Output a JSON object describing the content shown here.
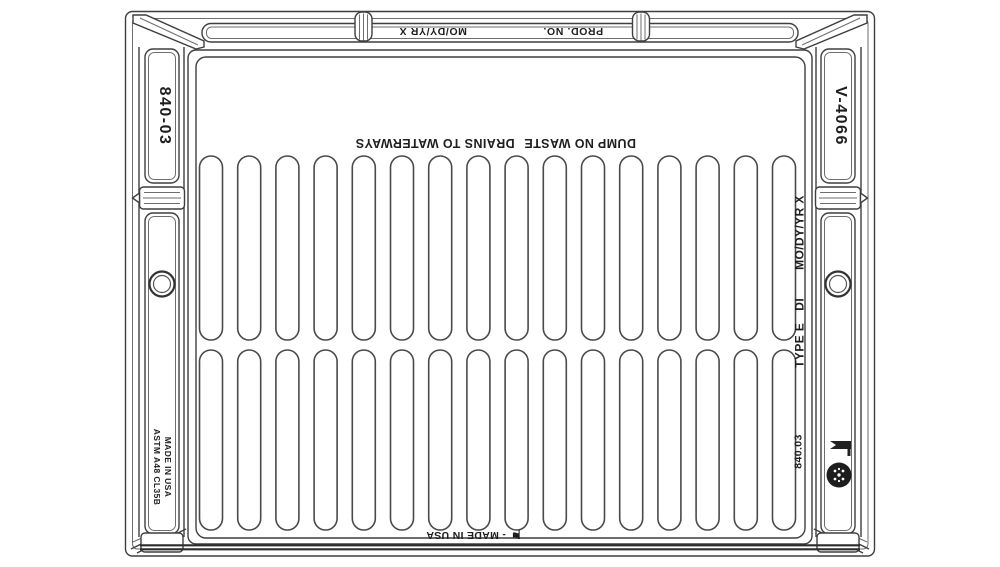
{
  "frame": {
    "prod_no_label": "PROD. NO.",
    "date_stamp_label": "MO/DY/YR X",
    "left_rail_model": "840-03",
    "right_rail_model": "V-4066",
    "origin_line1": "MADE IN USA",
    "origin_line2": "ASTM A48 CL35B"
  },
  "grate": {
    "warning_primary": "DUMP NO WASTE",
    "warning_secondary": "DRAINS TO WATERWAYS",
    "type_label": "TYPE E",
    "material_label": "DI",
    "date_stamp_label": "MO/DY/YR X",
    "catalog_number": "840.03",
    "origin_label": "- MADE IN USA",
    "rows": 2,
    "slots_per_row": 16
  },
  "icons": {
    "flag_glyph": "⚑",
    "foundry_logo": "round-foundry-mark"
  },
  "colors": {
    "line": "#3f3f3f",
    "text": "#1f1f1f",
    "background": "#ffffff"
  }
}
